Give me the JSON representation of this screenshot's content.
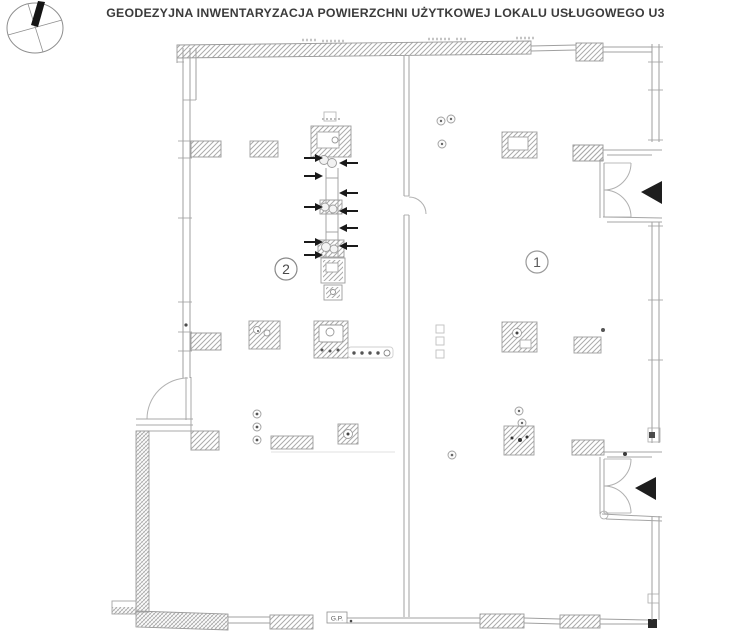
{
  "title": "GEODEZYJNA INWENTARYZACJA POWIERZCHNI UŻYTKOWEJ LOKALU USŁUGOWEGO U3",
  "rooms": [
    {
      "number": "1"
    },
    {
      "number": "2"
    }
  ],
  "markers": {
    "bottom_box_label": "G.P."
  },
  "icons": {
    "north_arrow": "compass-circle-with-black-needle",
    "entrance_arrow": "solid-black-triangle-pointing-left",
    "measure_arrow_right": "solid-black-arrow-pointing-right",
    "measure_arrow_left": "solid-black-arrow-pointing-left"
  },
  "colors": {
    "background": "#ffffff",
    "wall_line": "#9e9e9e",
    "hatch": "#ababab",
    "dark_marks": "#1d1d1d",
    "title_text": "#3b3b3b"
  }
}
